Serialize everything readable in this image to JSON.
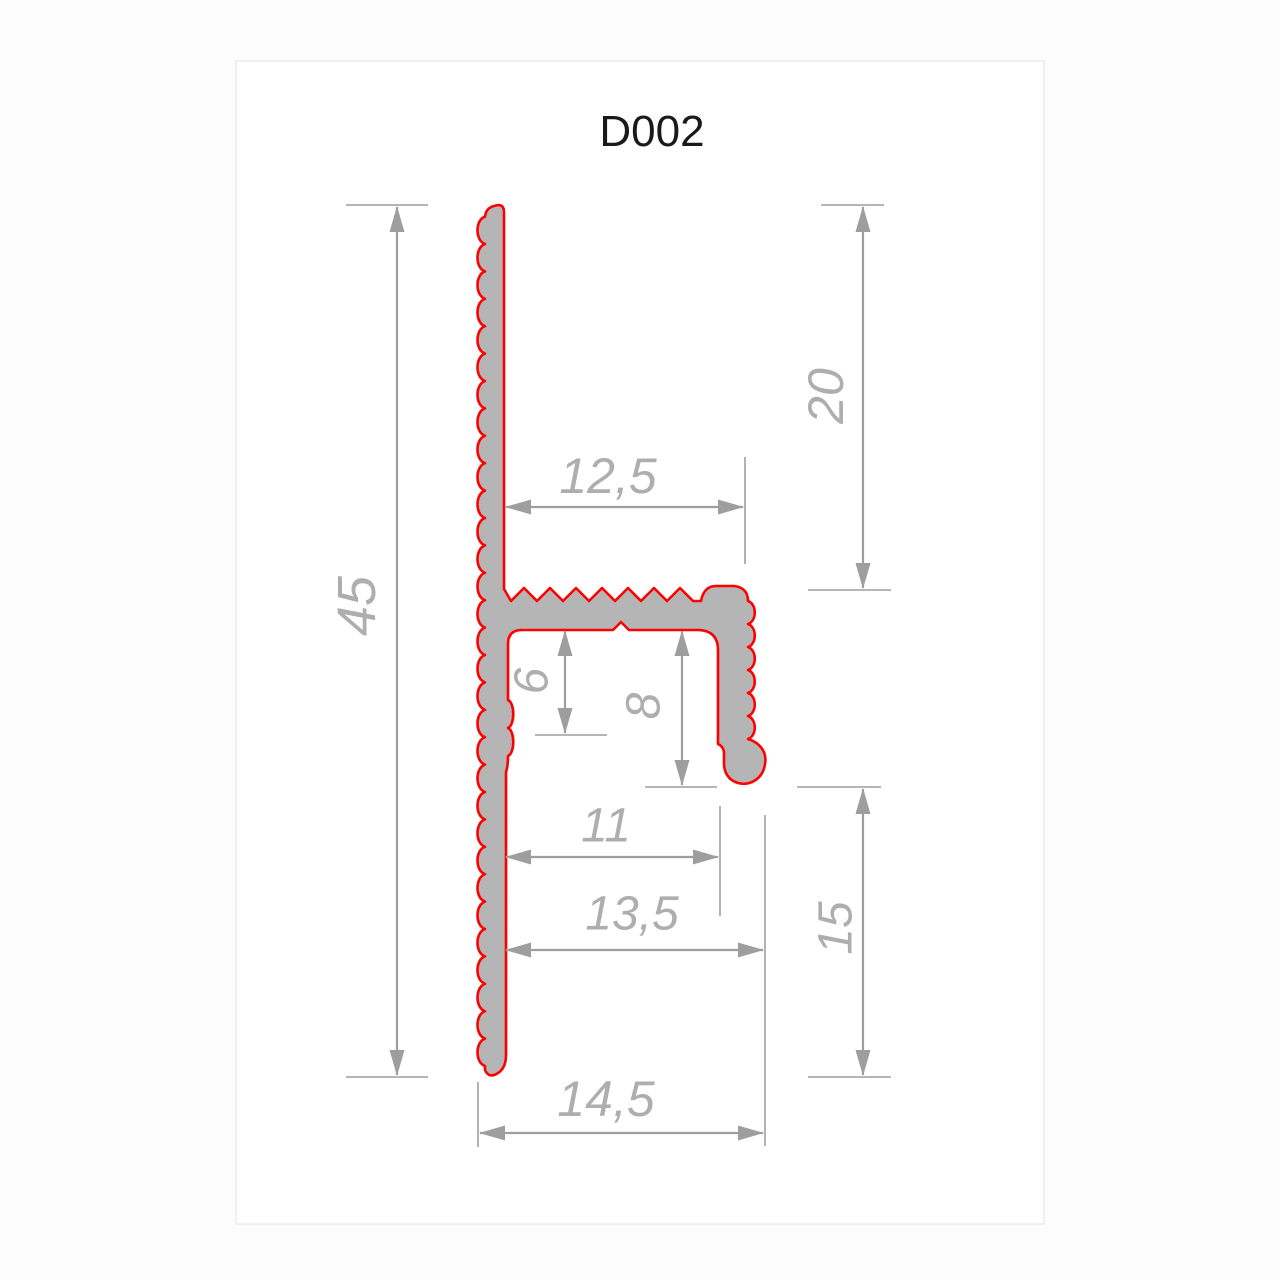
{
  "page": {
    "title": "D002"
  },
  "colors": {
    "background": "#fcfcfc",
    "sheet_fill": "#ffffff",
    "sheet_border": "#ececec",
    "profile_fill": "#b5b5b5",
    "profile_outline": "#ff0000",
    "dimension_line": "#9e9e9e",
    "dimension_text": "#aeaeae",
    "title_text": "#1a1a1a"
  },
  "diagram": {
    "type": "technical-drawing",
    "part_code": "D002",
    "description": "aluminium profile cross-section with serrated flanges",
    "dimensions": [
      {
        "name": "overall-height",
        "label": "45",
        "axis": "v",
        "line": [
          397,
          207,
          397,
          1075
        ],
        "ext": [
          [
            346,
            205,
            428,
            205
          ],
          [
            346,
            1077,
            428,
            1077
          ]
        ],
        "lx": 357,
        "ly": 606,
        "rot": true,
        "fs": 54
      },
      {
        "name": "upper-flange-height",
        "label": "20",
        "axis": "v",
        "line": [
          863,
          207,
          863,
          588
        ],
        "ext": [
          [
            821,
            205,
            884,
            205
          ],
          [
            808,
            590,
            891,
            590
          ]
        ],
        "lx": 826,
        "ly": 396,
        "rot": true,
        "fs": 50
      },
      {
        "name": "top-arm-width",
        "label": "12,5",
        "axis": "h",
        "line": [
          506,
          507,
          743,
          507
        ],
        "ext": [
          [
            745,
            457,
            745,
            564
          ]
        ],
        "lx": 608,
        "ly": 476,
        "rot": false,
        "fs": 50
      },
      {
        "name": "pocket-depth-6",
        "label": "6",
        "axis": "v",
        "line": [
          565,
          631,
          565,
          733
        ],
        "ext": [
          [
            535,
            735,
            607,
            735
          ]
        ],
        "lx": 532,
        "ly": 681,
        "rot": true,
        "fs": 48
      },
      {
        "name": "pocket-depth-8",
        "label": "8",
        "axis": "v",
        "line": [
          682,
          631,
          682,
          785
        ],
        "ext": [
          [
            645,
            787,
            717,
            787
          ]
        ],
        "lx": 644,
        "ly": 706,
        "rot": true,
        "fs": 48
      },
      {
        "name": "inner-width-11",
        "label": "11",
        "axis": "h",
        "line": [
          506,
          857,
          718,
          857
        ],
        "ext": [
          [
            720,
            806,
            720,
            916
          ]
        ],
        "lx": 606,
        "ly": 826,
        "rot": false,
        "fs": 48
      },
      {
        "name": "hook-width-13-5",
        "label": "13,5",
        "axis": "h",
        "line": [
          506,
          950,
          763,
          950
        ],
        "ext": [
          [
            765,
            815,
            765,
            1146
          ]
        ],
        "lx": 632,
        "ly": 914,
        "rot": false,
        "fs": 48
      },
      {
        "name": "lower-height-15",
        "label": "15",
        "axis": "v",
        "line": [
          863,
          789,
          863,
          1075
        ],
        "ext": [
          [
            797,
            787,
            881,
            787
          ],
          [
            808,
            1077,
            891,
            1077
          ]
        ],
        "lx": 836,
        "ly": 928,
        "rot": true,
        "fs": 48
      },
      {
        "name": "overall-width",
        "label": "14,5",
        "axis": "h",
        "line": [
          480,
          1133,
          763,
          1133
        ],
        "ext": [
          [
            478,
            1082,
            478,
            1147
          ]
        ],
        "lx": 606,
        "ly": 1099,
        "rot": false,
        "fs": 50
      }
    ]
  }
}
